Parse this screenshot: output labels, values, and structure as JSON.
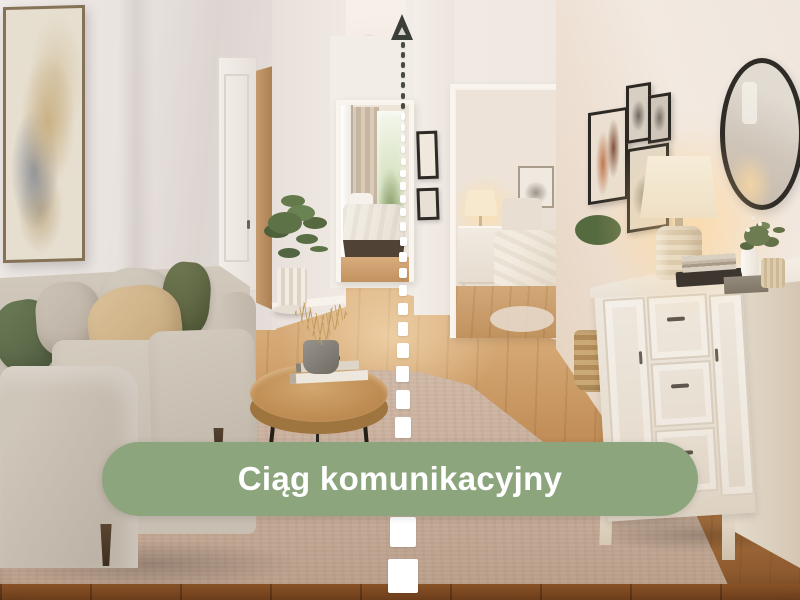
{
  "annotation": {
    "banner_label": "Ciąg komunikacyjny",
    "banner_color": "#8CA57D",
    "banner_text_color": "#FFFFFF",
    "route_line_color": "#FFFFFF",
    "route_line_dark_color": "#474B42",
    "arrow_color": "#3A3E37"
  },
  "palette": {
    "wall": "#EDE6E0",
    "ceiling": "#F6EEE8",
    "wood_floor": "#C3905A",
    "rug": "#C6AE9C",
    "sofa": "#C9C0B3",
    "dresser": "#EBE3D7",
    "plant_green": "#5E7247"
  }
}
